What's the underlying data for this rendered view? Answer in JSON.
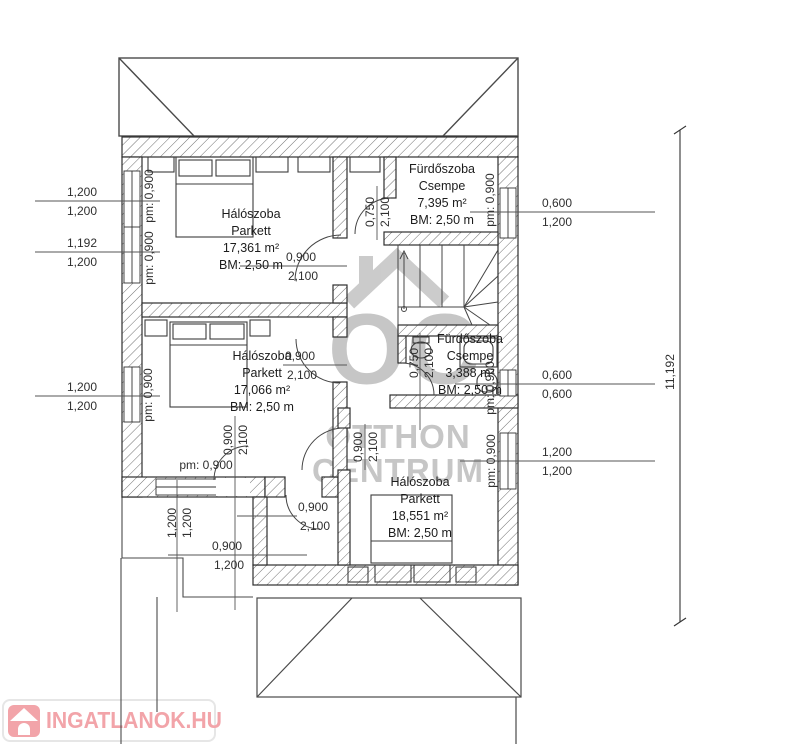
{
  "drawing": {
    "rooms": {
      "bedroom_top": {
        "name": "Hálószoba",
        "floor": "Parkett",
        "area": "17,361 m²",
        "ceiling": "BM: 2,50 m"
      },
      "bathroom_top": {
        "name": "Fürdőszoba",
        "floor": "Csempe",
        "area": "7,395 m²",
        "ceiling": "BM: 2,50 m"
      },
      "bedroom_mid": {
        "name": "Hálószoba",
        "floor": "Parkett",
        "area": "17,066 m²",
        "ceiling": "BM: 2,50 m"
      },
      "bathroom_mid": {
        "name": "Fürdőszoba",
        "floor": "Csempe",
        "area": "3,388 m²",
        "ceiling": "BM: 2,50 m"
      },
      "bedroom_bottom": {
        "name": "Hálószoba",
        "floor": "Parkett",
        "area": "18,551 m²",
        "ceiling": "BM: 2,50 m"
      }
    },
    "dims": {
      "left_top": {
        "a": "1,200",
        "b": "1,200"
      },
      "left_mid": {
        "a": "1,192",
        "b": "1,200"
      },
      "left_low": {
        "a": "1,200",
        "b": "1,200"
      },
      "right_top": {
        "a": "0,600",
        "b": "1,200"
      },
      "right_mid": {
        "a": "0,600",
        "b": "0,600"
      },
      "right_low": {
        "a": "1,200",
        "b": "1,200"
      },
      "door_bed1": {
        "a": "0,900",
        "b": "2,100"
      },
      "door_bath1": {
        "a": "0,750",
        "b": "2,100"
      },
      "door_bed2": {
        "a": "0,900",
        "b": "2,100"
      },
      "door_balcony": {
        "a": "0,900",
        "b": "2,100"
      },
      "door_bed3": {
        "a": "0,900",
        "b": "2,100"
      },
      "door_bath2": {
        "a": "0,750",
        "b": "2,100"
      },
      "door_hall": {
        "a": "0,900",
        "b": "2,100"
      },
      "door_terrace": {
        "a": "0,900",
        "b": "1,200"
      },
      "balcony": {
        "a": "1,200",
        "b": "1,200"
      },
      "overall_height": "11,192"
    },
    "parapets": {
      "left_a": "pm: 0,900",
      "left_b": "pm: 0,900",
      "left_c": "pm: 0,900",
      "bottom": "pm: 0,900",
      "right_a": "pm: 0,900",
      "right_b": "pm: 0,900",
      "right_c": "pm: 0,900"
    },
    "watermark": {
      "monogram": "OC",
      "line1": "OTTHON",
      "line2": "CENTRUM"
    },
    "brand": {
      "logo_text": "INGATLANOK.HU"
    },
    "colors": {
      "line": "#3a3a3a",
      "dim_text": "#2f2f2f",
      "watermark": "#c6c6c6",
      "brand_pink": "#f0959b"
    }
  }
}
